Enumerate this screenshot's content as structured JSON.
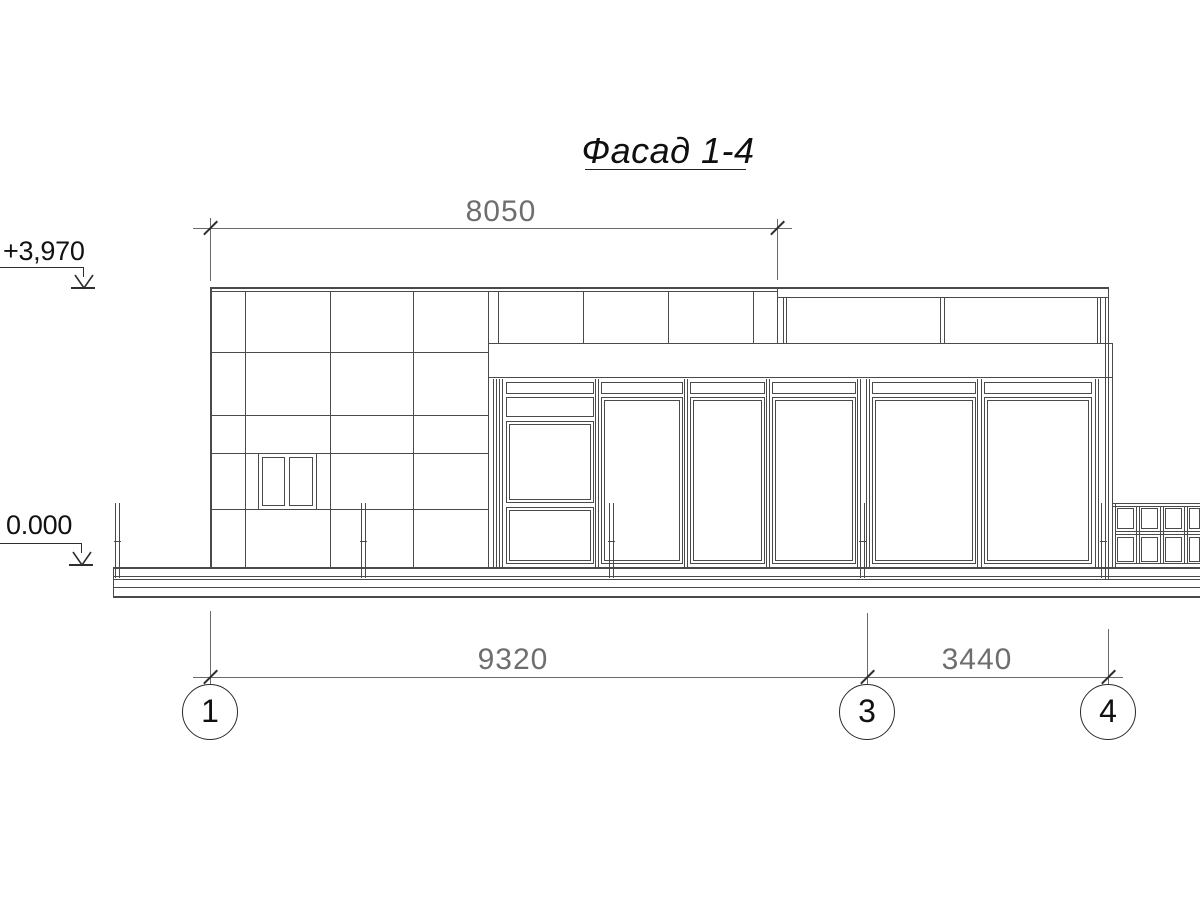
{
  "drawing": {
    "title": "Фасад 1-4"
  },
  "dimensions": {
    "top": "8050",
    "bottom_left": "9320",
    "bottom_right": "3440"
  },
  "elevations": {
    "roof": "+3,970",
    "ground": "0.000"
  },
  "axes": [
    {
      "label": "1"
    },
    {
      "label": "3"
    },
    {
      "label": "4"
    }
  ],
  "colors": {
    "ink": "#4a4a4a",
    "dim_line": "#6a6a6a",
    "dim_text": "#6e6e6e",
    "marker": "#2e2e2e",
    "background": "#ffffff"
  }
}
